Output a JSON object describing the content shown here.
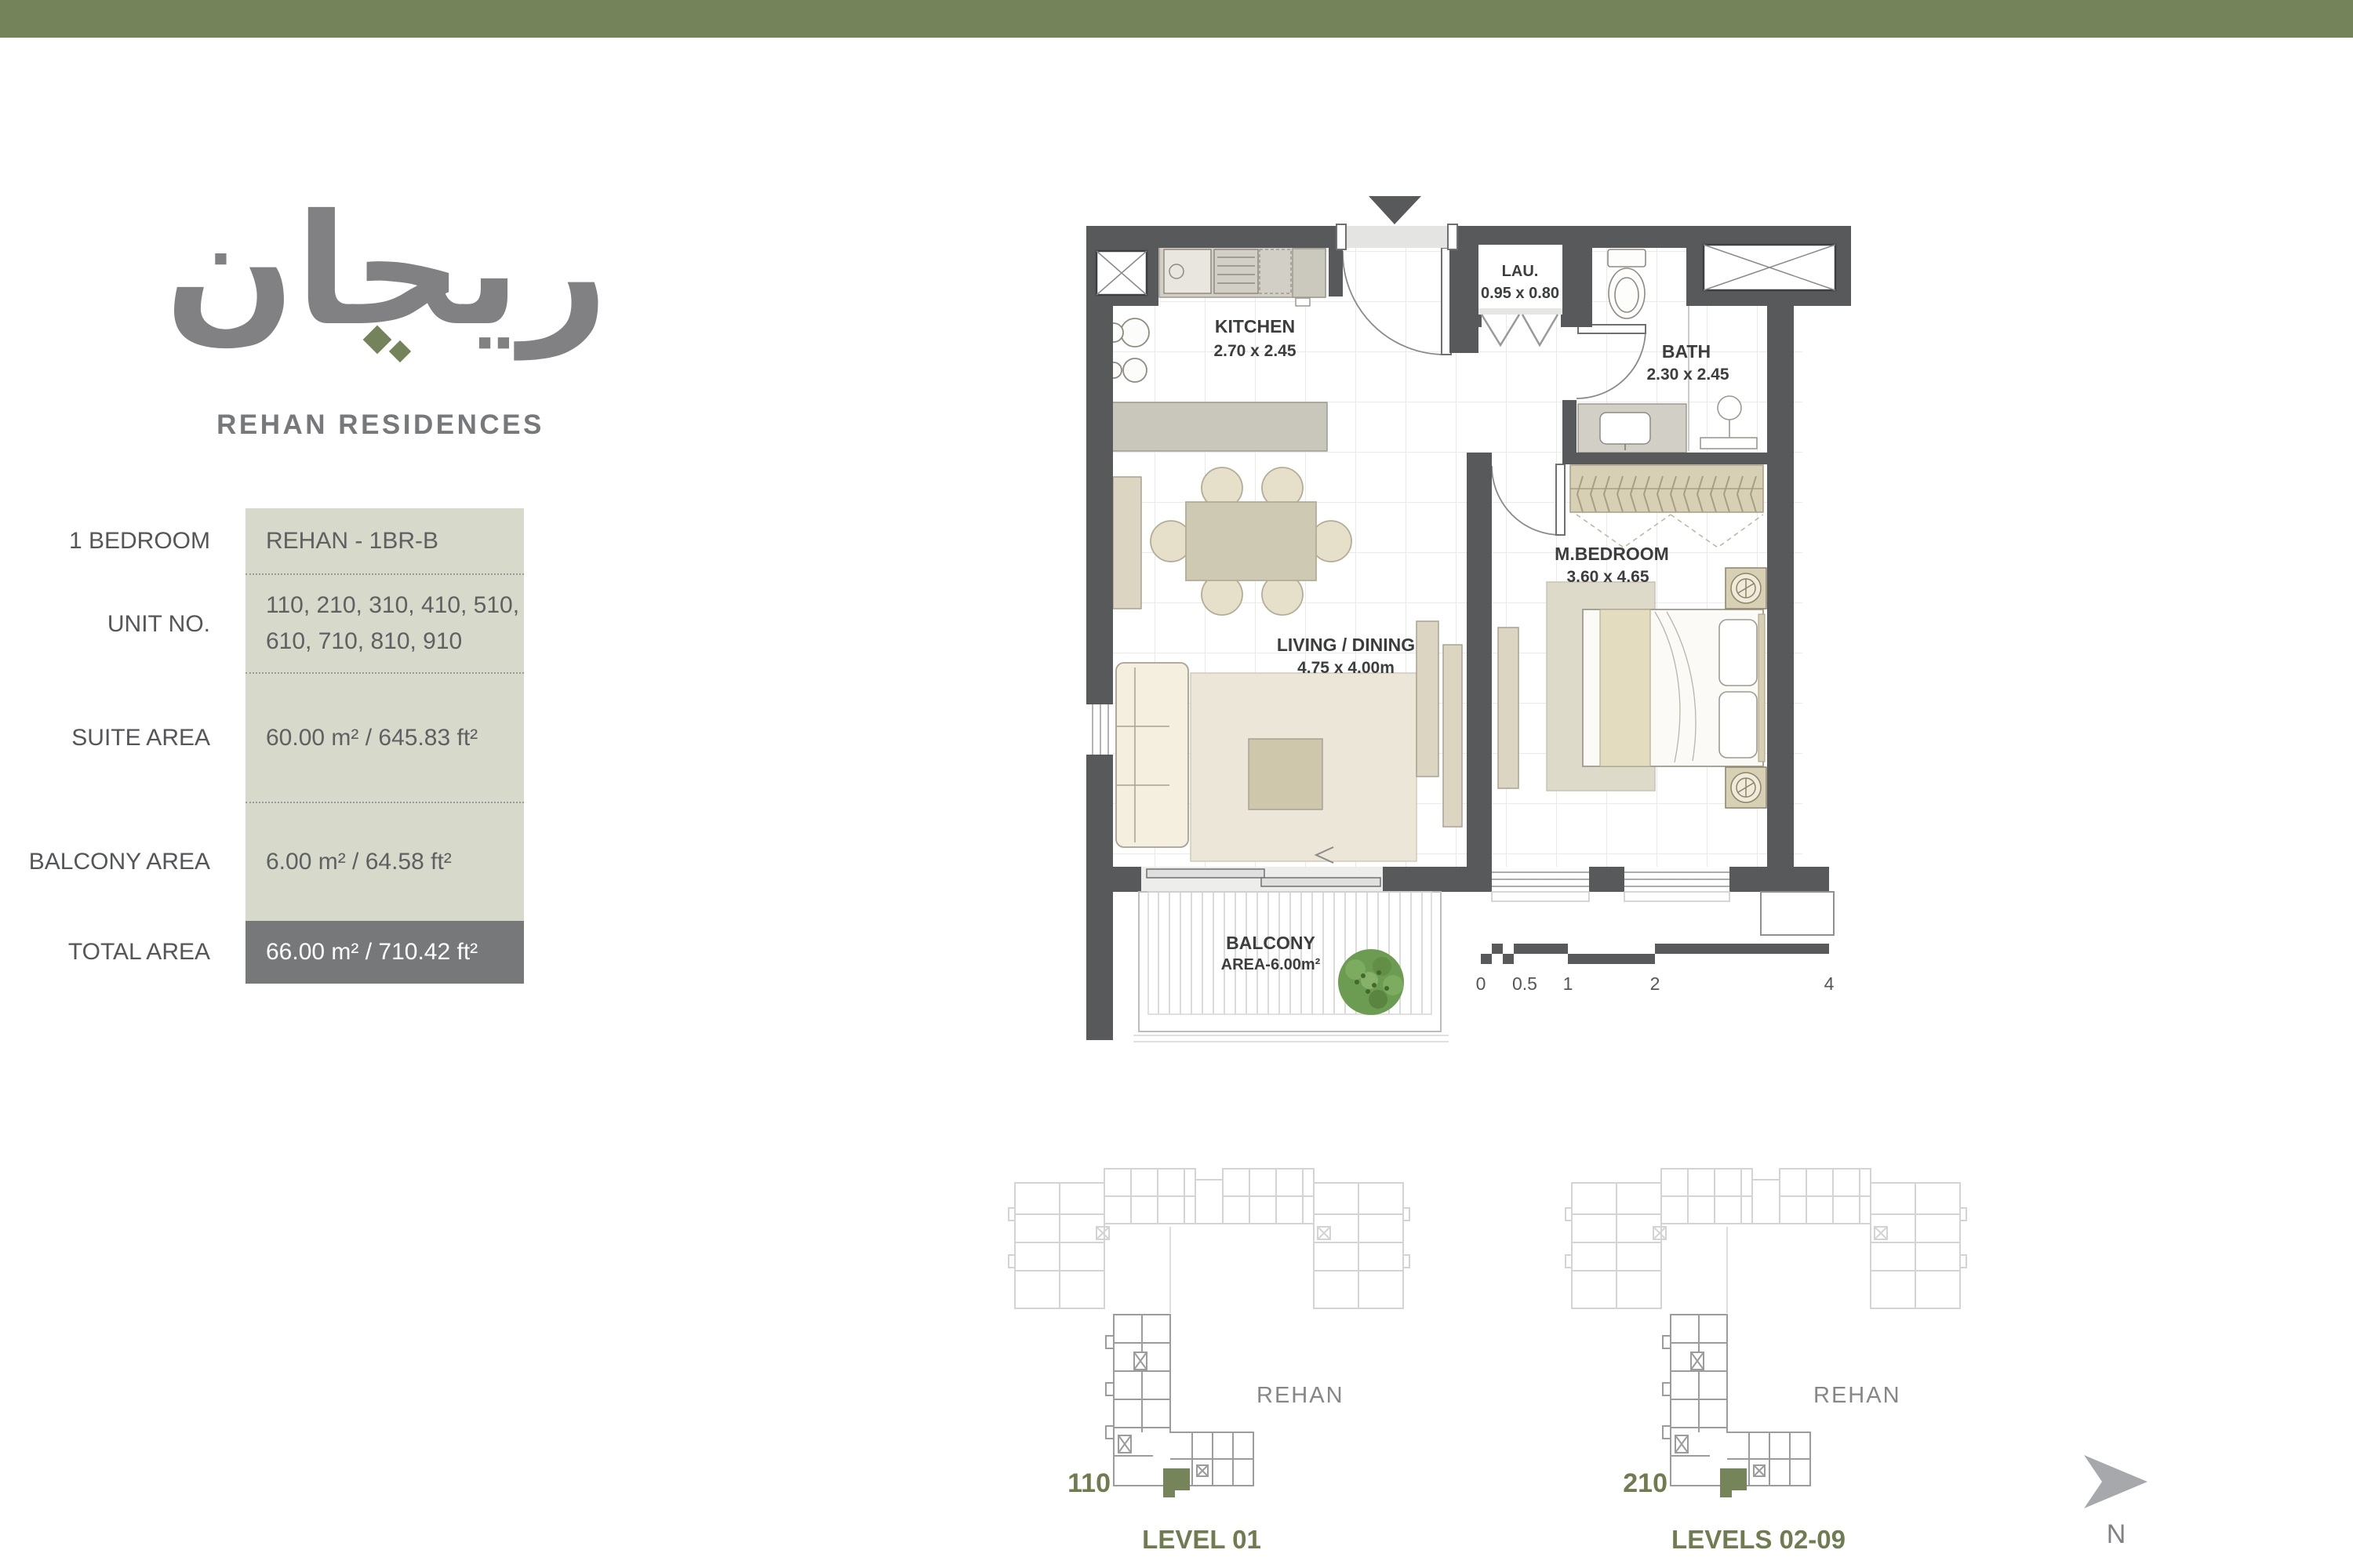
{
  "brand": {
    "logo": "ريحان",
    "wordmark": "REHAN RESIDENCES"
  },
  "spec_table": {
    "rows": [
      {
        "label": "1 BEDROOM",
        "value": "REHAN - 1BR-B"
      },
      {
        "label": "UNIT NO.",
        "value_line1": "110, 210, 310, 410, 510,",
        "value_line2": "610, 710, 810, 910"
      },
      {
        "label": "SUITE AREA",
        "value": "60.00 m² /  645.83 ft²"
      },
      {
        "label": "BALCONY AREA",
        "value": "6.00 m² / 64.58 ft²"
      },
      {
        "label": "TOTAL AREA",
        "value": "66.00 m² / 710.42 ft²"
      }
    ]
  },
  "floor_plan": {
    "rooms": [
      {
        "name": "KITCHEN",
        "dims": "2.70 x 2.45"
      },
      {
        "name": "LAU.",
        "dims": "0.95 x 0.80"
      },
      {
        "name": "BATH",
        "dims": "2.30 x 2.45"
      },
      {
        "name": "M.BEDROOM",
        "dims": "3.60 x 4.65"
      },
      {
        "name": "LIVING / DINING",
        "dims": "4.75 x 4.00m"
      },
      {
        "name": "BALCONY",
        "dims": "AREA-6.00m²"
      }
    ],
    "scale_ticks": [
      "0",
      "0.5",
      "1",
      "2",
      "4"
    ]
  },
  "key_plans": [
    {
      "unit": "110",
      "building": "REHAN",
      "level": "LEVEL 01"
    },
    {
      "unit": "210",
      "building": "REHAN",
      "level": "LEVELS 02-09"
    }
  ],
  "compass": {
    "label": "N"
  }
}
